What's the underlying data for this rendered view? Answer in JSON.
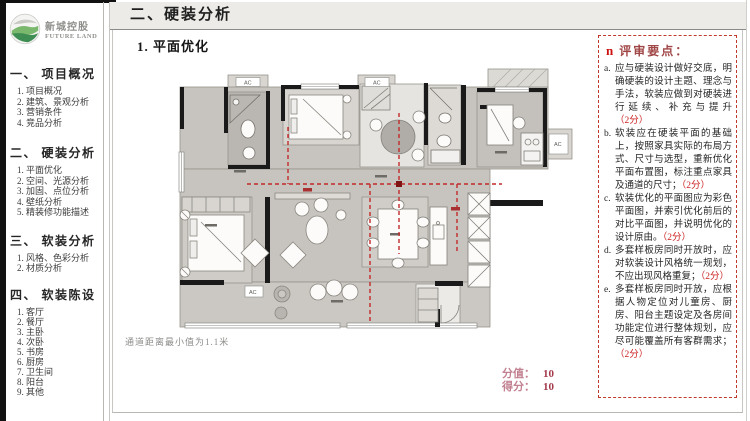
{
  "brand": {
    "name_cn": "新城控股",
    "name_en": "FUTURE LAND"
  },
  "title_bar": {
    "title": "二、硬装分析"
  },
  "sidebar": {
    "sections": [
      {
        "heading": "一、 项目概况",
        "items": [
          "1. 项目概况",
          "2. 建筑、景观分析",
          "3. 营销条件",
          "4. 竞品分析"
        ]
      },
      {
        "heading": "二、 硬装分析",
        "items": [
          "1. 平面优化",
          "2. 空间、光源分析",
          "3. 加固、点位分析",
          "4. 壁纸分析",
          "5. 精装修功能描述"
        ]
      },
      {
        "heading": "三、 软装分析",
        "items": [
          "1. 风格、色彩分析",
          "2. 材质分析"
        ]
      },
      {
        "heading": "四、 软装陈设",
        "items": [
          "1. 客厅",
          "2. 餐厅",
          "3. 主卧",
          "4. 次卧",
          "5. 书房",
          "6. 厨房",
          "7. 卫生间",
          "8. 阳台",
          "9. 其他"
        ]
      }
    ]
  },
  "main": {
    "section_title": "1.  平面优化",
    "caption": "通道距离最小值为1.1米",
    "score_label": "分值：",
    "score_value": "10",
    "got_label": "得分：",
    "got_value": "10",
    "plan": {
      "ac_label": "AC"
    }
  },
  "review_panel": {
    "bullet": "n",
    "heading": "评审要点：",
    "items": [
      {
        "label": "a.",
        "text": "应与硬装设计做好交底，明 确硬装的设计主题、理念与 手法，软装应做到对硬装进 行延续、补充与提升",
        "score": "（2分）"
      },
      {
        "label": "b.",
        "text": "软装应在硬装平面的基础上，按照家具实际的布局方式、尺寸与选型，重新优化平面布置图，标注重点家具及通道的尺寸；",
        "score": "（2分）"
      },
      {
        "label": "c.",
        "text": "软装优化的平面图应为彩色平面图，并索引优化前后的对比平面图，并说明优化的设计原由。",
        "score": "（2分）"
      },
      {
        "label": "d.",
        "text": "多套样板房同时开放时，应对软装设计风格统一规划，不应出现风格重复；",
        "score": "（2分）"
      },
      {
        "label": "e.",
        "text": "多套样板房同时开放，应根据人物定位对儿童房、厨房、阳台主题设定及各房间功能定位进行整体规划，应尽可能覆盖所有客群需求；",
        "score": "（2分）"
      }
    ]
  }
}
